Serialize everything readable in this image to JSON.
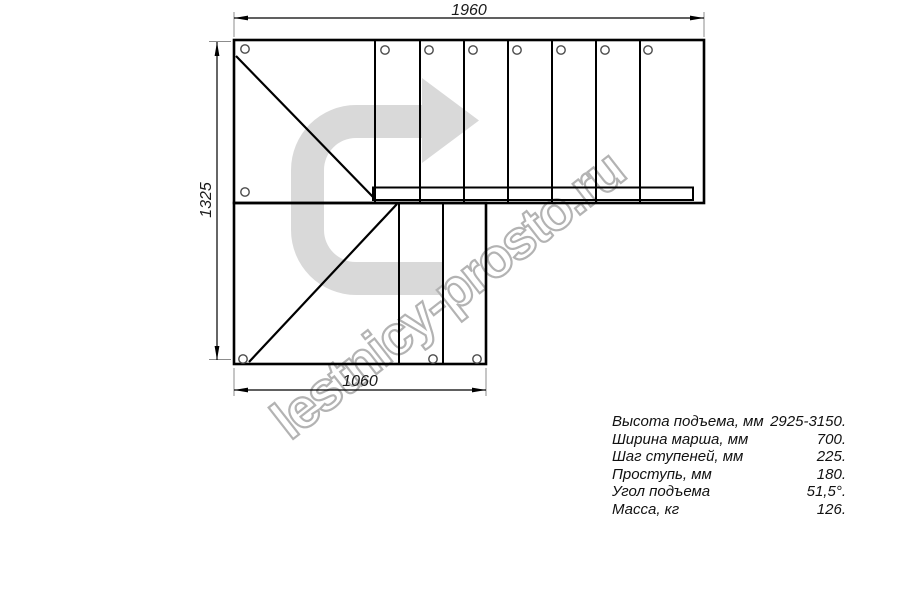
{
  "dimensions": {
    "top_width_mm": "1960",
    "left_height_mm": "1325",
    "bottom_width_mm": "1060"
  },
  "watermark": {
    "text": "lestnicy-prosto.ru"
  },
  "icons": {
    "direction_arrow": "turn-right-arrow"
  },
  "colors": {
    "line": "#000000",
    "extension_line": "#8c8c8c",
    "arrow_fill": "#d9d9d9",
    "watermark_stroke": "#b3b3b3",
    "hole_stroke": "#4a4a4a"
  },
  "specs": {
    "rows": [
      {
        "label": "Высота подъема, мм",
        "value": "2925-3150."
      },
      {
        "label": "Ширина марша, мм",
        "value": "700."
      },
      {
        "label": "Шаг ступеней, мм",
        "value": "225."
      },
      {
        "label": "Проступь, мм",
        "value": "180."
      },
      {
        "label": "Угол подъема",
        "value": "51,5°."
      },
      {
        "label": "Масса, кг",
        "value": "126."
      }
    ]
  }
}
